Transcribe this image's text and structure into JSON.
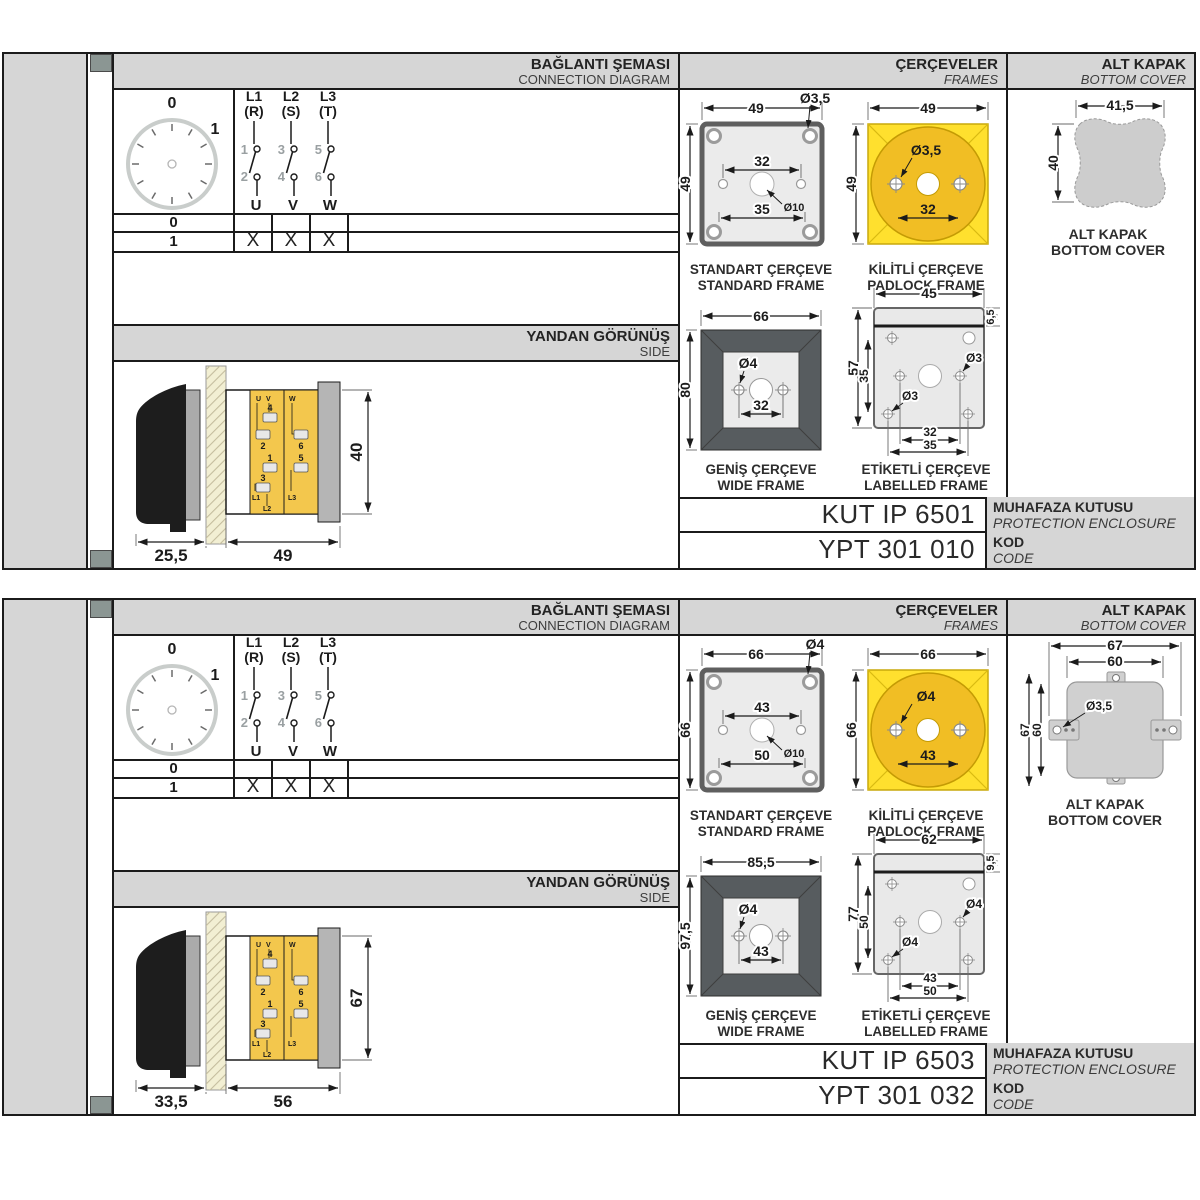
{
  "shared": {
    "headers": {
      "connection_tr": "BAĞLANTI ŞEMASI",
      "connection_en": "CONNECTION DIAGRAM",
      "frames_tr": "ÇERÇEVELER",
      "frames_en": "FRAMES",
      "cover_tr": "ALT KAPAK",
      "cover_en": "BOTTOM COVER",
      "side_tr": "YANDAN GÖRÜNÜŞ",
      "side_en": "SIDE"
    }
  },
  "sections": [
    {
      "sidebar": {
        "title_tr": "10A 3 Faz Aç-Kapa Şalter",
        "title_en": "10A 3 Phase On-Off Switch"
      },
      "connection": {
        "dial": {
          "pos0": "0",
          "pos1": "1"
        },
        "poles": [
          {
            "line": "L1",
            "phase": "(R)",
            "top": "1",
            "bottom": "2",
            "out": "U"
          },
          {
            "line": "L2",
            "phase": "(S)",
            "top": "3",
            "bottom": "4",
            "out": "V"
          },
          {
            "line": "L3",
            "phase": "(T)",
            "top": "5",
            "bottom": "6",
            "out": "W"
          }
        ],
        "table": {
          "rows": [
            {
              "pos": "0",
              "marks": [
                "",
                "",
                ""
              ]
            },
            {
              "pos": "1",
              "marks": [
                "X",
                "X",
                "X"
              ]
            }
          ]
        }
      },
      "side_view": {
        "dim_handle": "25,5",
        "dim_body": "49",
        "dim_height": "40",
        "terminals": {
          "u": "U",
          "v": "V",
          "w": "W",
          "n1": "1",
          "n2": "2",
          "n3": "3",
          "n4": "4",
          "n5": "5",
          "n6": "6",
          "l1": "L1",
          "l2": "L2",
          "l3": "L3"
        }
      },
      "frames": {
        "standard": {
          "title_tr": "STANDART ÇERÇEVE",
          "title_en": "STANDARD FRAME",
          "dim_width": "49",
          "dim_height": "49",
          "dim_hole": "Ø3,5",
          "dim_inner": "32",
          "dim_lower": "35",
          "dim_center": "Ø10"
        },
        "padlock": {
          "title_tr": "KİLİTLİ ÇERÇEVE",
          "title_en": "PADLOCK FRAME",
          "dim_width": "49",
          "dim_height": "49",
          "dim_hole": "Ø3,5",
          "dim_span": "32"
        },
        "wide": {
          "title_tr": "GENİŞ ÇERÇEVE",
          "title_en": "WIDE FRAME",
          "dim_width": "66",
          "dim_height": "80",
          "dim_hole": "Ø4",
          "dim_span": "32"
        },
        "labelled": {
          "title_tr": "ETİKETLİ ÇERÇEVE",
          "title_en": "LABELLED FRAME",
          "dim_width": "45",
          "dim_label_h": "6,5",
          "dim_height": "57",
          "dim_inner_h": "35",
          "dim_hole_top": "Ø3",
          "dim_hole_bottom": "Ø3",
          "dim_span1": "32",
          "dim_span2": "35"
        }
      },
      "bottom_cover": {
        "title_tr": "ALT KAPAK",
        "title_en": "BOTTOM COVER",
        "blob": {
          "dim_width": "41,5",
          "dim_height": "40"
        }
      },
      "codes": {
        "enclosure_value": "KUT IP 6501",
        "enclosure_label_tr": "MUHAFAZA KUTUSU",
        "enclosure_label_en": "PROTECTION ENCLOSURE",
        "code_value": "YPT 301 010",
        "code_label_tr": "KOD",
        "code_label_en": "CODE"
      }
    },
    {
      "sidebar": {
        "title_tr": "32A 3 Faz Aç-Kapa Şalter",
        "title_en": "32A 3 Phase On-Off Switch"
      },
      "connection": {
        "dial": {
          "pos0": "0",
          "pos1": "1"
        },
        "poles": [
          {
            "line": "L1",
            "phase": "(R)",
            "top": "1",
            "bottom": "2",
            "out": "U"
          },
          {
            "line": "L2",
            "phase": "(S)",
            "top": "3",
            "bottom": "4",
            "out": "V"
          },
          {
            "line": "L3",
            "phase": "(T)",
            "top": "5",
            "bottom": "6",
            "out": "W"
          }
        ],
        "table": {
          "rows": [
            {
              "pos": "0",
              "marks": [
                "",
                "",
                ""
              ]
            },
            {
              "pos": "1",
              "marks": [
                "X",
                "X",
                "X"
              ]
            }
          ]
        }
      },
      "side_view": {
        "dim_handle": "33,5",
        "dim_body": "56",
        "dim_height": "67",
        "terminals": {
          "u": "U",
          "v": "V",
          "w": "W",
          "n1": "1",
          "n2": "2",
          "n3": "3",
          "n4": "4",
          "n5": "5",
          "n6": "6",
          "l1": "L1",
          "l2": "L2",
          "l3": "L3"
        }
      },
      "frames": {
        "standard": {
          "title_tr": "STANDART ÇERÇEVE",
          "title_en": "STANDARD FRAME",
          "dim_width": "66",
          "dim_height": "66",
          "dim_hole": "Ø4",
          "dim_inner": "43",
          "dim_lower": "50",
          "dim_center": "Ø10"
        },
        "padlock": {
          "title_tr": "KİLİTLİ ÇERÇEVE",
          "title_en": "PADLOCK FRAME",
          "dim_width": "66",
          "dim_height": "66",
          "dim_hole": "Ø4",
          "dim_span": "43"
        },
        "wide": {
          "title_tr": "GENİŞ ÇERÇEVE",
          "title_en": "WIDE FRAME",
          "dim_width": "85,5",
          "dim_height": "97,5",
          "dim_hole": "Ø4",
          "dim_span": "43"
        },
        "labelled": {
          "title_tr": "ETİKETLİ ÇERÇEVE",
          "title_en": "LABELLED FRAME",
          "dim_width": "62",
          "dim_label_h": "9,5",
          "dim_height": "77",
          "dim_inner_h": "50",
          "dim_hole_top": "Ø4",
          "dim_hole_bottom": "Ø4",
          "dim_span1": "43",
          "dim_span2": "50"
        }
      },
      "bottom_cover": {
        "title_tr": "ALT KAPAK",
        "title_en": "BOTTOM COVER",
        "tabbed": {
          "dim_w_outer": "67",
          "dim_w_inner": "60",
          "dim_h_outer": "67",
          "dim_h_inner": "60",
          "dim_hole": "Ø3,5"
        }
      },
      "codes": {
        "enclosure_value": "KUT IP 6503",
        "enclosure_label_tr": "MUHAFAZA KUTUSU",
        "enclosure_label_en": "PROTECTION ENCLOSURE",
        "code_value": "YPT 301 032",
        "code_label_tr": "KOD",
        "code_label_en": "CODE"
      }
    }
  ]
}
